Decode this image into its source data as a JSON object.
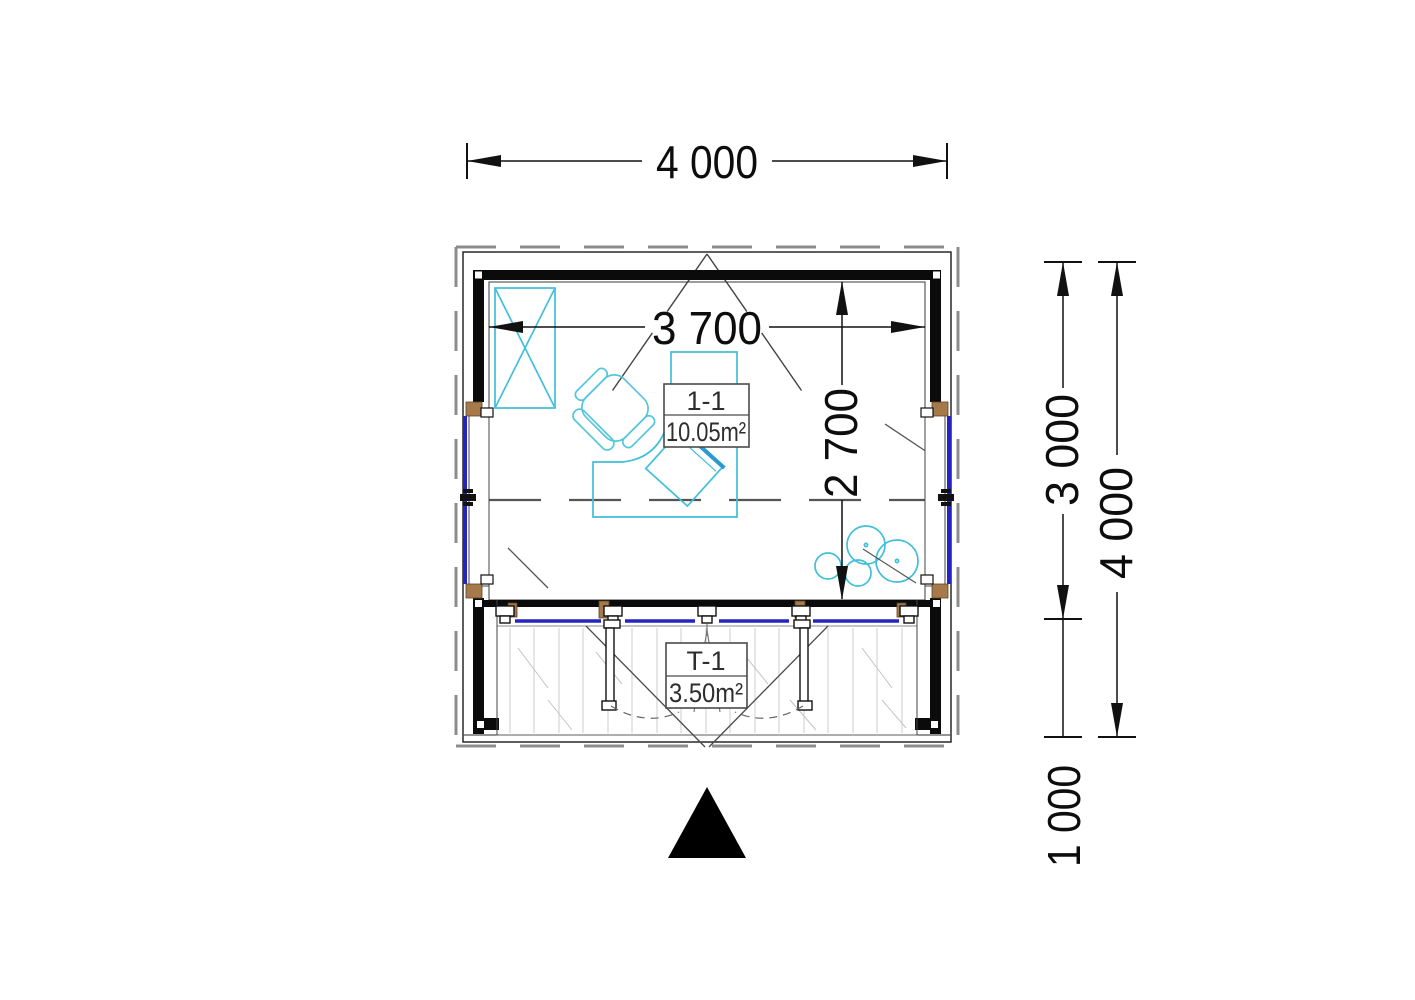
{
  "plan": {
    "dims": {
      "top_width": "4 000",
      "inner_width": "3 700",
      "inner_depth": "2 700",
      "room_depth": "3 000",
      "total_depth": "4 000",
      "terrace_depth": "1 000"
    },
    "rooms": [
      {
        "id": "1-1",
        "area": "10.05m²"
      },
      {
        "id": "T-1",
        "area": "3.50m²"
      }
    ],
    "colors": {
      "wall_black": "#0b0b0b",
      "furniture_cyan": "#3fbfd8",
      "glazing_blue": "#2424c2",
      "timber_brown": "#a5794a",
      "overhang_gray": "#8c8c8c"
    }
  }
}
